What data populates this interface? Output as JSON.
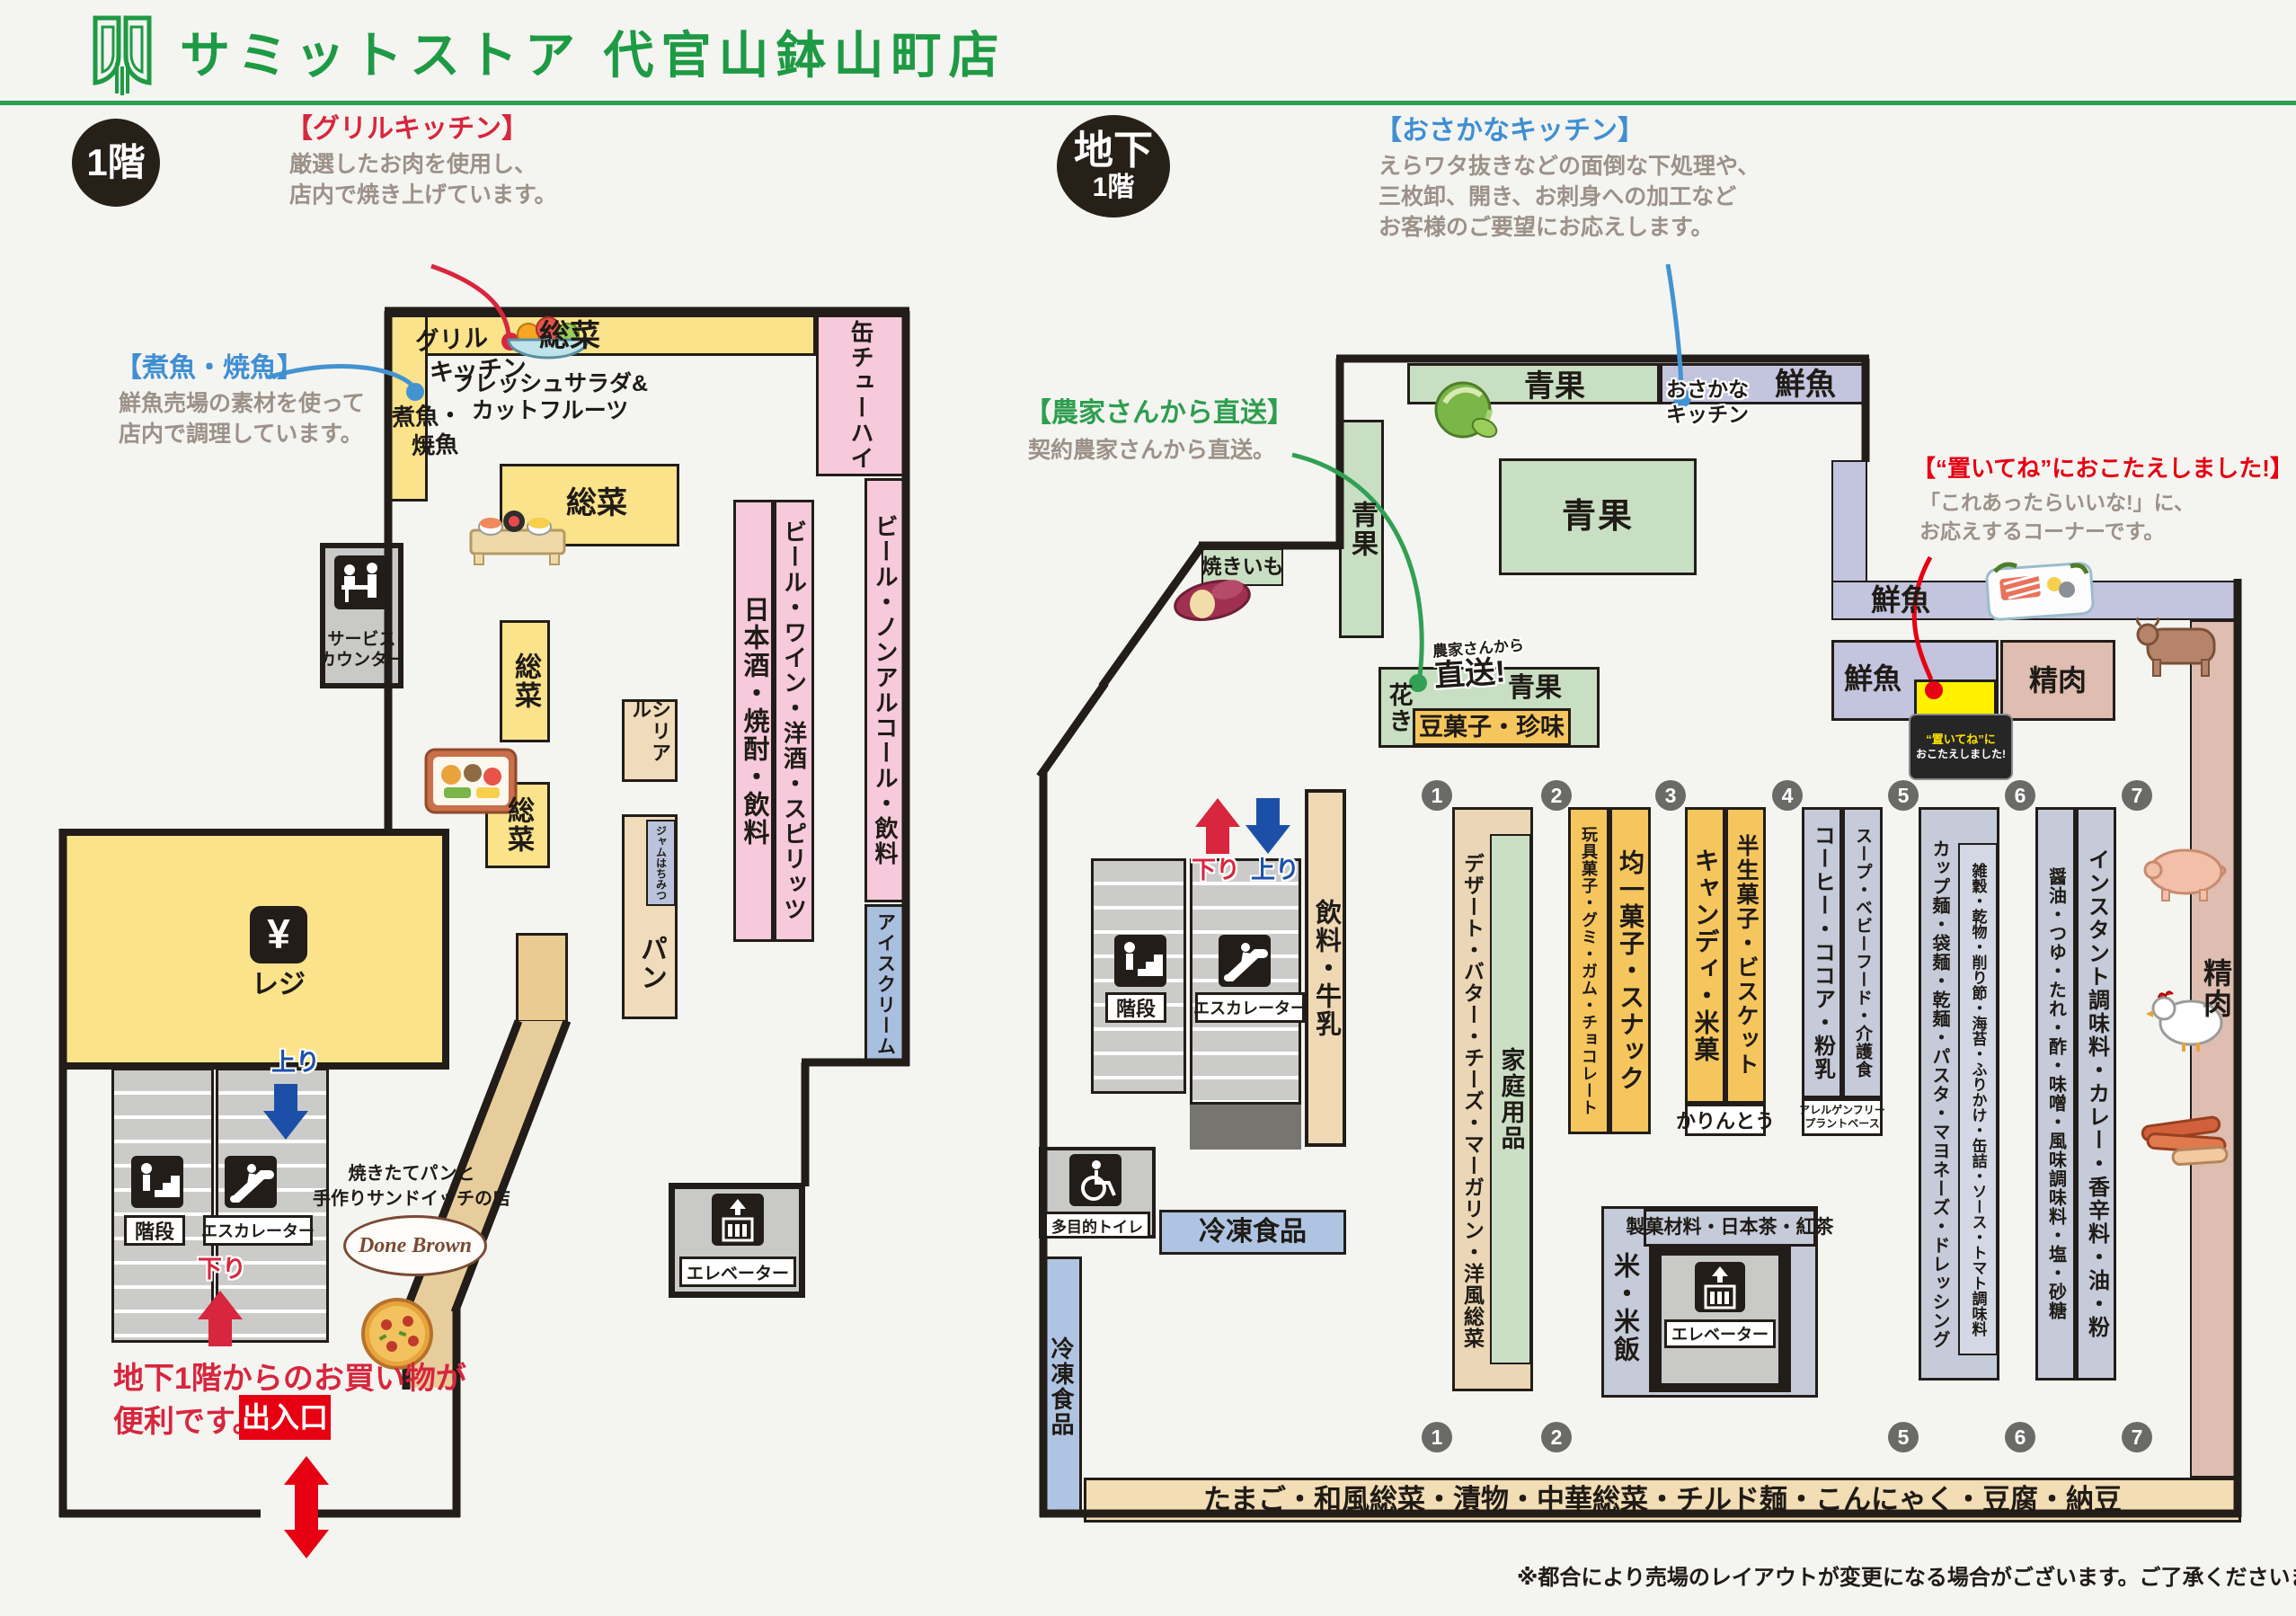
{
  "header": {
    "title": "サミットストア 代官山鉢山町店"
  },
  "footnote": "※都合により売場のレイアウトが変更になる場合がございます。ご了承くださいませ。",
  "colors": {
    "brand_green": "#1e9a44",
    "wall": "#221d18",
    "yellow": "#fae38a",
    "pink": "#f6c9db",
    "beige": "#f0dcba",
    "blue": "#a9bfdf",
    "freezer_blue": "#afc4e2",
    "produce_green": "#c9dfc3",
    "fish_lavender": "#c3c4de",
    "meat_pink": "#dfbdb1",
    "snack_orange": "#f6c65e",
    "grocery_gray": "#c6cbda",
    "annotation_red": "#d7263d",
    "annotation_blue": "#3f8fd2",
    "annotation_green": "#31a053",
    "highlight_yellow": "#fff100"
  },
  "floor1": {
    "badge": "1階",
    "annotations": {
      "grill": {
        "title": "【グリルキッチン】",
        "body1": "厳選したお肉を使用し、",
        "body2": "店内で焼き上げています。"
      },
      "fish": {
        "title": "【煮魚・焼魚】",
        "body1": "鮮魚売場の素材を使って",
        "body2": "店内で調理しています。"
      }
    },
    "labels": {
      "grill_hand1": "グリル",
      "grill_hand2": "キッチン",
      "nizakana1": "煮魚・",
      "nizakana2": "焼魚",
      "sozai": "総菜",
      "fresh1": "フレッシュサラダ&",
      "fresh2": "カットフルーツ",
      "kanchuhai": "缶チューハイ",
      "beer_nonal": "ビール・ノンアルコール・飲料",
      "icecream": "アイスクリーム",
      "nihonshu": "日本酒・焼酎・飲料",
      "beer_wine": "ビール・ワイン・洋酒・スピリッツ",
      "cereal": "シリアル",
      "jam": "ジャムはちみつ",
      "pan": "パン",
      "service1": "サービス",
      "service2": "カウンター",
      "yen": "¥",
      "reji": "レジ",
      "kaidan": "階段",
      "escalator": "エスカレーター",
      "nobori": "上り",
      "kudari": "下り",
      "note1": "地下1階からのお買い物が",
      "note2": "便利です。",
      "exit": "出入口",
      "bakery1": "焼きたてパンと",
      "bakery2": "手作りサンドイッチの店",
      "donebrown": "Done Brown",
      "elevator": "エレベーター"
    }
  },
  "basement": {
    "badge1": "地下",
    "badge2": "1階",
    "annotations": {
      "osakana": {
        "title": "【おさかなキッチン】",
        "body1": "えらワタ抜きなどの面倒な下処理や、",
        "body2": "三枚卸、開き、お刺身への加工など",
        "body3": "お客様のご要望にお応えします。"
      },
      "nouka": {
        "title": "【農家さんから直送】",
        "body1": "契約農家さんから直送。"
      },
      "oitene": {
        "title": "【“置いてね”におこたえしました!】",
        "body1": "「これあったらいいな!」に、",
        "body2": "お応えするコーナーです。"
      }
    },
    "labels": {
      "seika": "青果",
      "sengyo": "鮮魚",
      "seiniku": "精肉",
      "osakana1": "おさかな",
      "osakana2": "キッチン",
      "yakiimo": "焼きいも",
      "hanaki": "花き",
      "chokuso1": "農家さんから",
      "chokuso2": "直送!",
      "mamegashi": "豆菓子・珍味",
      "inryo": "飲料・牛乳",
      "kaidan": "階段",
      "escalator": "エスカレーター",
      "nobori": "上り",
      "kudari": "下り",
      "tamokuteki": "多目的トイレ",
      "reito": "冷凍食品",
      "kome": "米・米飯",
      "seikazairyo": "製菓材料・日本茶・紅茶",
      "elevator": "エレベーター",
      "badge_oitene1": "“置いてね”に",
      "badge_oitene2": "おこたえしました!",
      "karinto": "かりんとう",
      "allergen1": "アレルゲンフリー",
      "allergen2": "プラントベース",
      "bottom_band": "たまご・和風総菜・漬物・中華総菜・チルド麺・こんにゃく・豆腐・納豆"
    },
    "aisles": {
      "a1a": "デザート・バター・チーズ・マーガリン・洋風総菜",
      "a1b": "家庭用品",
      "a2a": "玩具菓子・グミ・ガム・チョコレート",
      "a2b": "均一菓子・スナック",
      "a3a": "キャンディ・米菓",
      "a3b": "半生菓子・ビスケット",
      "a4a": "コーヒー・ココア・粉乳",
      "a4b": "スープ・ベビーフード・介護食",
      "a5a": "カップ麺・袋麺・乾麺・パスタ・マヨネーズ・ドレッシング",
      "a5b": "雑穀・乾物・削り節・海苔・ふりかけ・缶詰・ソース・トマト調味料",
      "a6a": "醤油・つゆ・たれ・酢・味噌・風味調味料・塩・砂糖",
      "a6b": "インスタント調味料・カレー・香辛料・油・粉"
    },
    "numbers": [
      "1",
      "2",
      "3",
      "4",
      "5",
      "6",
      "7"
    ]
  }
}
